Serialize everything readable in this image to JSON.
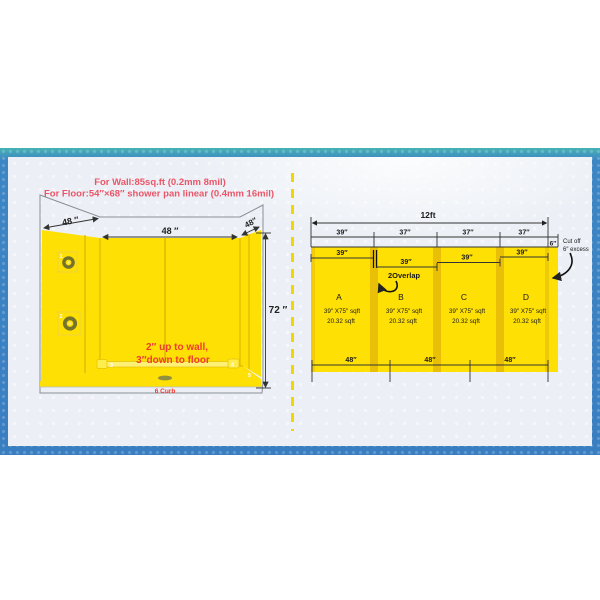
{
  "colors": {
    "frame_blue": "#3a7ec2",
    "frame_teal": "#46b3b4",
    "canvas_bg": "#ecf0f6",
    "panel_yellow": "#ffe005",
    "panel_yellow_dark": "#e9c007",
    "divider_yellow": "#f2d602",
    "header_red": "#ea5668",
    "note_red": "#f03a30"
  },
  "header": {
    "line1": "For Wall:85sq.ft (0.2mm 8mil)",
    "line2": "For Floor:54″×68″ shower pan linear (0.4mm 16mil)"
  },
  "left_diagram": {
    "dim_left_wall": "48 ″",
    "dim_back_wall": "48 ″",
    "dim_right_wall": "48″",
    "dim_height": "72 ″",
    "note_line1": "2″ up to wall,",
    "note_line2": "3″down to floor",
    "curb_label": "6 Curb",
    "markers": [
      "1",
      "2",
      "3",
      "4",
      "5"
    ]
  },
  "right_diagram": {
    "total_label": "12ft",
    "top_segments": [
      "39″",
      "37″",
      "37″",
      "37″"
    ],
    "excess_label": "6″",
    "cutoff_line1": "Cut off",
    "cutoff_line2": "6″ excess",
    "overlap_label": "2Overlap",
    "sheet_widths": [
      "39″",
      "39″",
      "39″",
      "39″"
    ],
    "panels": [
      {
        "name": "A",
        "size": "39″ X75″ sqft",
        "area": "20.32 sqft"
      },
      {
        "name": "B",
        "size": "39″ X75″ sqft",
        "area": "20.32 sqft"
      },
      {
        "name": "C",
        "size": "39″ X75″ sqft",
        "area": "20.32 sqft"
      },
      {
        "name": "D",
        "size": "39″ X75″ sqft",
        "area": "20.32 sqft"
      }
    ],
    "bottom_segments": [
      "48″",
      "48″",
      "48″"
    ]
  }
}
